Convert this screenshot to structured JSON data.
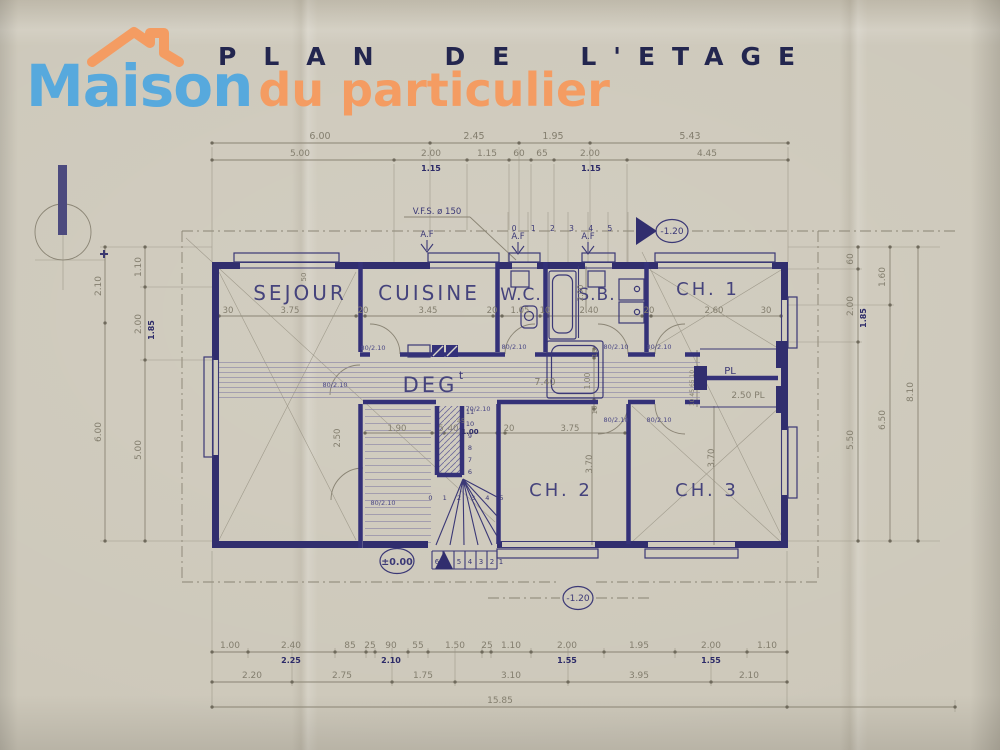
{
  "header": {
    "title_word1": "PLAN",
    "title_word2": "DE",
    "title_word3": "L'ETAGE",
    "logo": {
      "part1": "Maison",
      "part2": "du particulier"
    }
  },
  "colors": {
    "logo_blue": "#57a9dd",
    "logo_orange": "#f49c62",
    "ink_navy": "#312e6e",
    "pencil": "#8a8474",
    "paper": "#cdc8ba"
  },
  "rooms": {
    "sejour": "SEJOUR",
    "cuisine": "CUISINE",
    "wc": "W.C.",
    "sb": "S.B.",
    "ch1": "CH. 1",
    "deg": "DEG",
    "deg_sup": "t",
    "ch2": "CH. 2",
    "ch3": "CH. 3",
    "pl": "PL"
  },
  "annotations": {
    "vfs": "V.F.S. ø 150",
    "af": "A.F",
    "door80": "80/2.10",
    "door70": "70/2.10",
    "d45": "45",
    "d100": "1.00",
    "level_zero": "±0.00",
    "level_minus": "-1.20",
    "stairs_top": "0 1 2 3 4 5",
    "stairs_inner": "0 1 2 3 4 5",
    "stairs_bottom": [
      "6",
      "5",
      "4",
      "3",
      "2",
      "1"
    ],
    "stairs_col": [
      "6",
      "7",
      "8",
      "9",
      "10",
      "11"
    ]
  },
  "dims": {
    "top1": [
      "6.00",
      "2.45",
      "1.95",
      "5.43"
    ],
    "top2": [
      "5.00",
      "2.00",
      "1.15",
      "60",
      "65",
      "2.00",
      "4.45"
    ],
    "top2_dark": "1.15",
    "inner_top": [
      "30",
      "3.75",
      "20",
      "3.45",
      "20",
      "1.05",
      "10",
      "2.40",
      "20",
      "2.60",
      "30"
    ],
    "hall": "7.40",
    "hall_w": "1.00",
    "t10": "10",
    "d50": "50",
    "sb_h": "2.00",
    "mid": [
      "1.90",
      "5",
      "40",
      "20",
      "3.75"
    ],
    "ch2_h": "3.70",
    "ch3_h": "3.70",
    "left_wall_h": "2.50",
    "left_outer": [
      "2.10",
      "6.00"
    ],
    "left_inner": [
      "1.10",
      "2.00",
      "5.00"
    ],
    "left_dark": "1.85",
    "right_inner": [
      "60",
      "2.00",
      "5.50"
    ],
    "right_dark": "1.85",
    "right_mid": [
      "1.60",
      "6.50"
    ],
    "right_outer": "8.10",
    "bottom1": [
      "1.00",
      "2.40",
      "85",
      "25",
      "90",
      "55",
      "1.50",
      "25",
      "1.10",
      "2.00",
      "1.95",
      "2.00",
      "1.10"
    ],
    "bottom1_dark": [
      "2.25",
      "2.10",
      "1.55",
      "1.55"
    ],
    "bottom2": [
      "2.20",
      "2.75",
      "1.75",
      "3.10",
      "3.95",
      "2.10"
    ],
    "bottom3": "15.85",
    "pl_dims": "10 45 65 10",
    "pl_right": "2.50  PL"
  }
}
